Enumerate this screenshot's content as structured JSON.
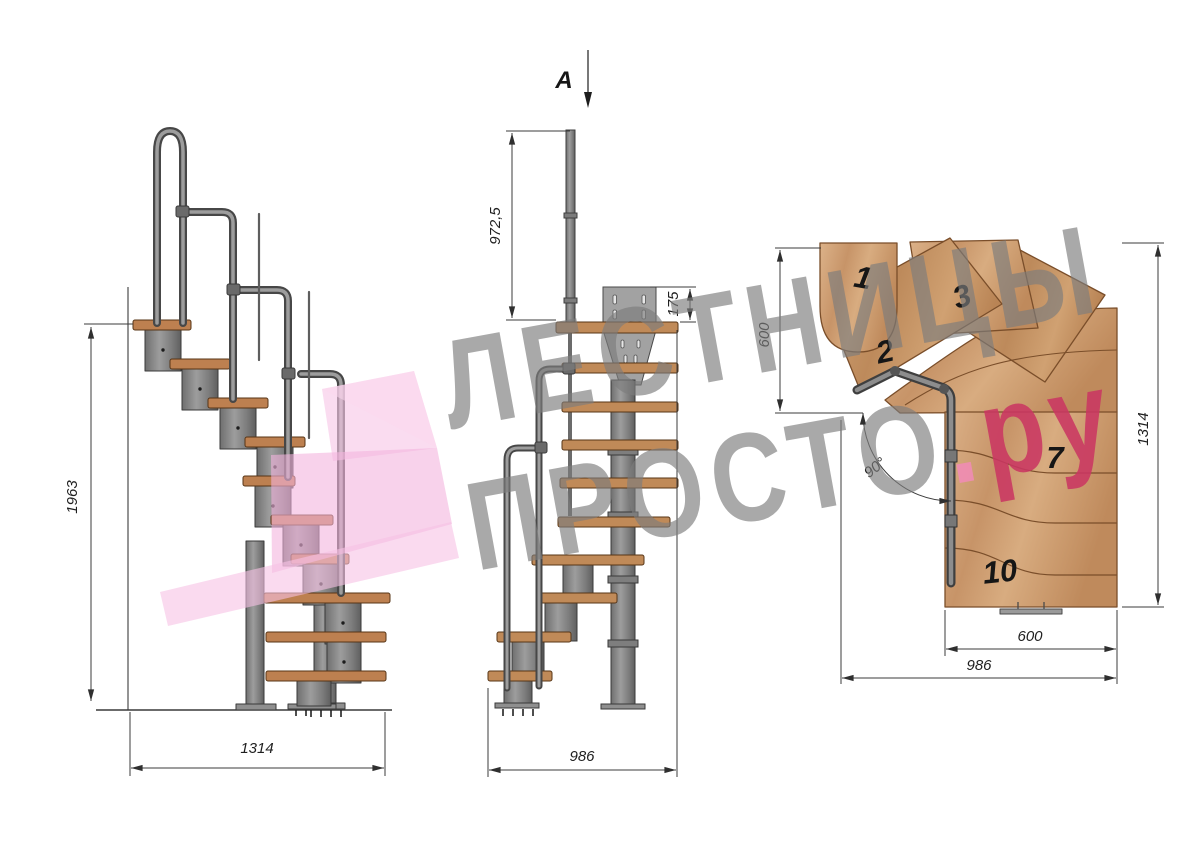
{
  "watermark": {
    "line1": "ЛЕСТНИЦЫ",
    "line2_main": "ПРОСТО",
    "dot": ".",
    "line2_suffix": "ру"
  },
  "section_cut": {
    "label": "A"
  },
  "side_view": {
    "height": "1963",
    "width": "1314"
  },
  "front_view": {
    "post_height": "972,5",
    "plate_height": "175",
    "width": "986"
  },
  "plan_view": {
    "flight_width": "600",
    "depth": "1314",
    "turn_angle": "90°",
    "bottom_width": "600",
    "total_width": "986",
    "steps": {
      "s1": "1",
      "s2": "2",
      "s3": "3",
      "s7": "7",
      "s10": "10"
    }
  },
  "colors": {
    "wood_plan": "#cfa077",
    "wood_side": "#bd8050",
    "metal": "#8c8c8c",
    "dim": "#333333",
    "watermark_gray": "#7d7d7d",
    "watermark_pink": "#ca3762",
    "logo_pink": "#f5bfe2"
  }
}
